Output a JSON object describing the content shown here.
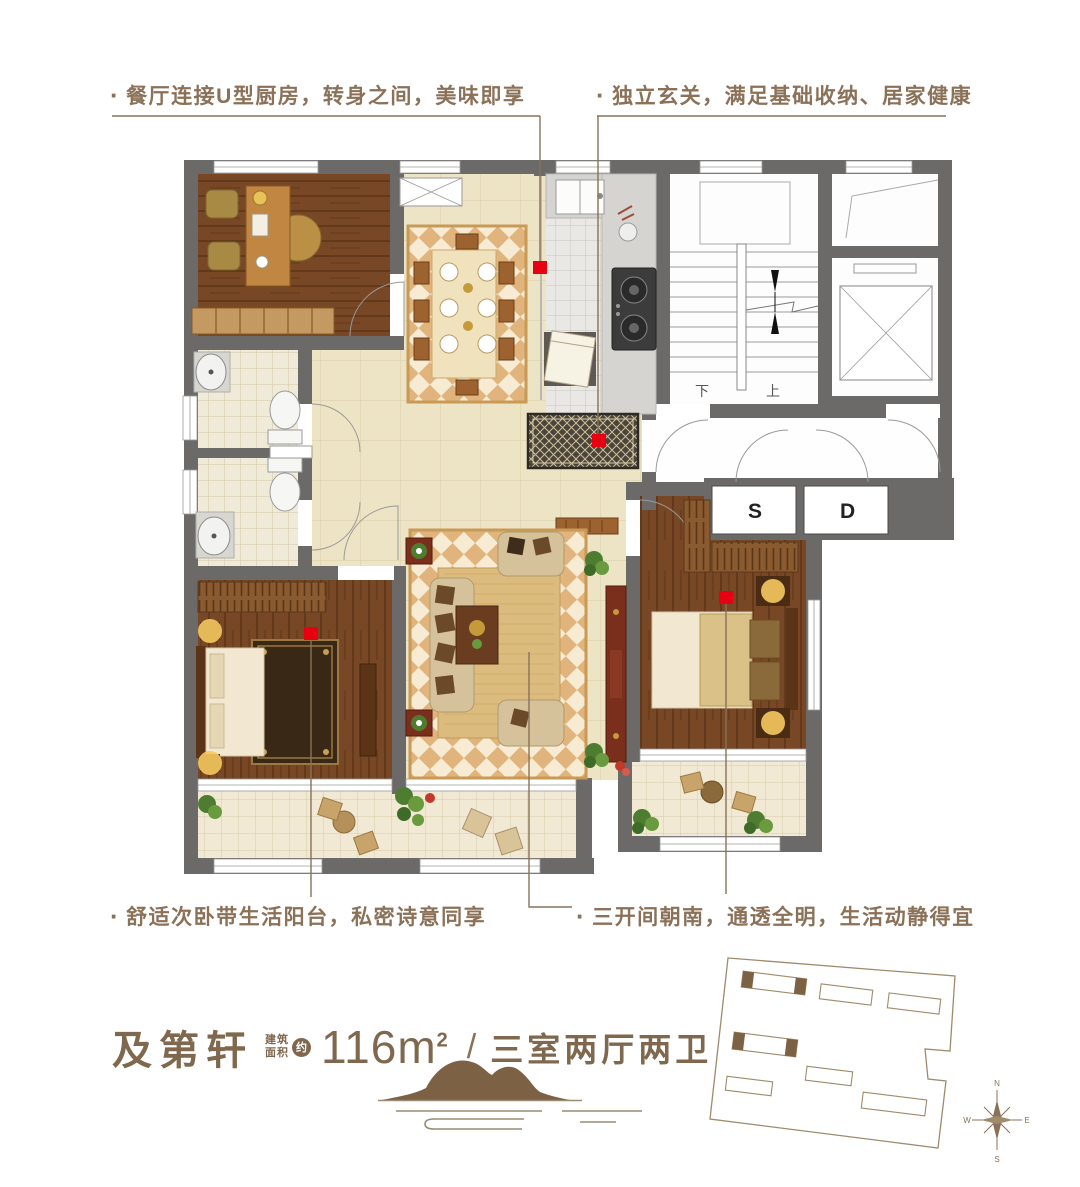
{
  "annotations": {
    "bullet": "·",
    "top_left": "餐厅连接U型厨房，转身之间，美味即享",
    "top_right": "独立玄关，满足基础收纳、居家健康",
    "bottom_left": "舒适次卧带生活阳台，私密诗意同享",
    "bottom_right": "三开间朝南，通透全明，生活动静得宜"
  },
  "title": {
    "name": "及第轩",
    "area_label_line1": "建筑",
    "area_label_line2": "面积",
    "area_approx": "约",
    "area_value": "116m",
    "area_sup": "2",
    "separator": "/",
    "layout": "三室两厅两卫"
  },
  "plan_labels": {
    "shaft_s": "S",
    "shaft_d": "D",
    "stair_up": "上",
    "stair_down": "下"
  },
  "compass": {
    "n": "N",
    "e": "E",
    "s": "S",
    "w": "W"
  },
  "colors": {
    "marker_red": "#e60012",
    "annotation_brown": "#8a7158",
    "title_brown": "#7f684e",
    "wall_gray": "#6b6a68",
    "wood_floor": "#774726",
    "rug_tan": "#e0b47c",
    "rug_cream": "#f7ecd3"
  }
}
